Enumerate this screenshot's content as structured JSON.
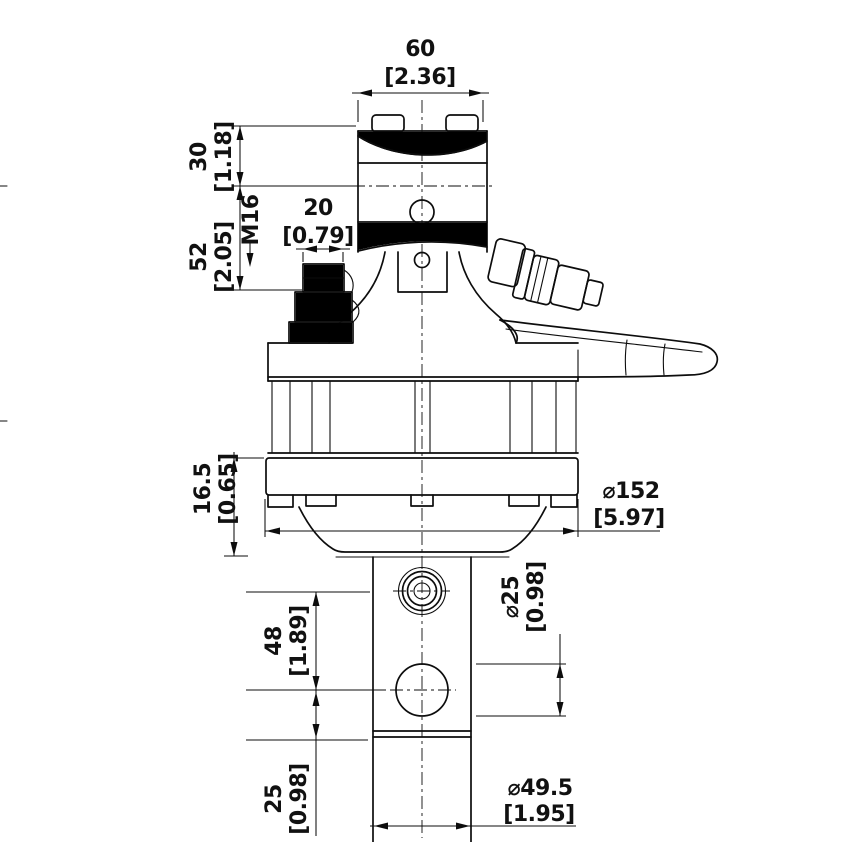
{
  "drawing": {
    "colors": {
      "line": "#0d0d0d",
      "background": "#ffffff"
    },
    "dimensions": {
      "top_width": {
        "mm": "60",
        "inch": "[2.36]"
      },
      "cap_height": {
        "mm": "30",
        "inch": "[1.18]"
      },
      "body_height": {
        "mm": "52",
        "inch": "[2.05]"
      },
      "thread": "M16",
      "port": {
        "mm": "20",
        "inch": "[0.79]"
      },
      "flange_thickness": {
        "mm": "16.5",
        "inch": "[0.65]"
      },
      "flange_diameter": {
        "mm": "⌀152",
        "inch": "[5.97]"
      },
      "pin_hole": {
        "mm": "⌀25",
        "inch": "[0.98]"
      },
      "hole_spacing": {
        "mm": "48",
        "inch": "[1.89]"
      },
      "hole_end_offset": {
        "mm": "25",
        "inch": "[0.98]"
      },
      "shaft_diameter": {
        "mm": "⌀49.5",
        "inch": "[1.95]"
      }
    }
  }
}
